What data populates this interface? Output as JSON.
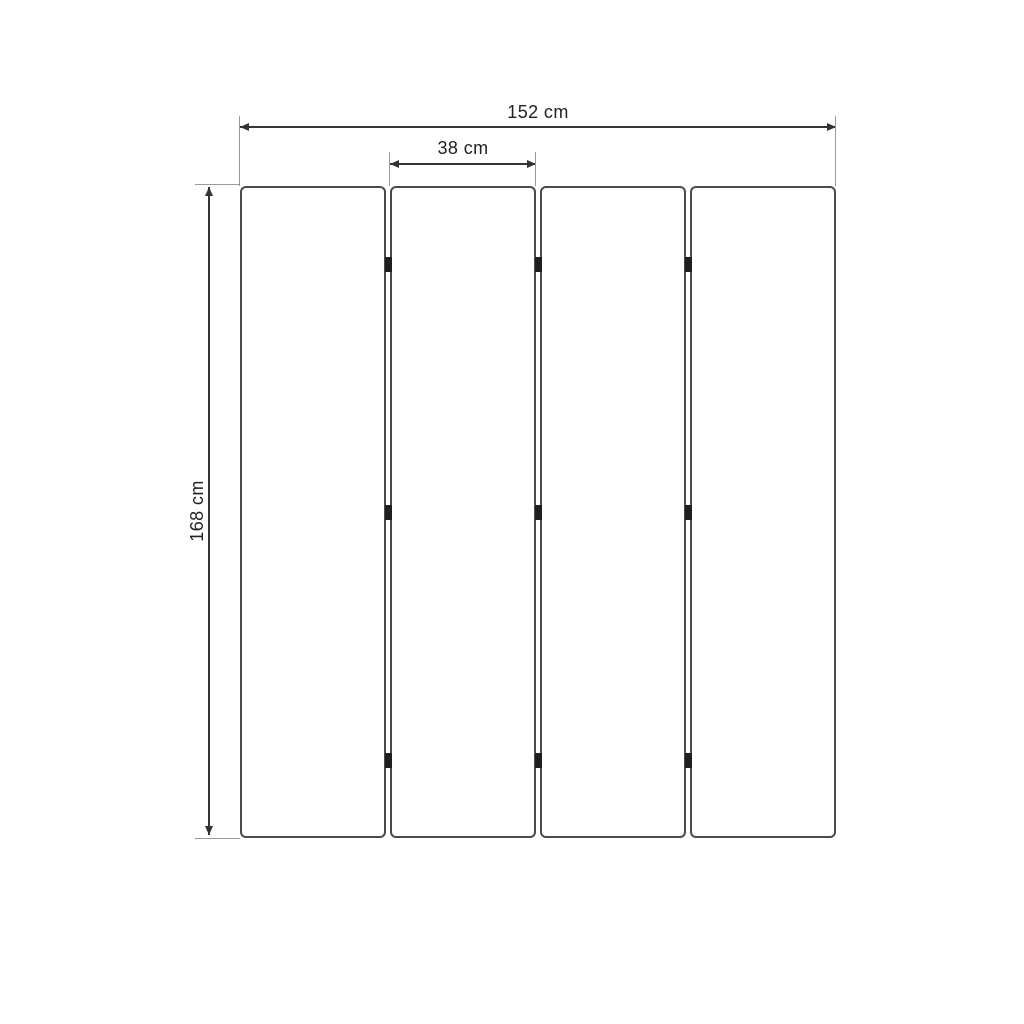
{
  "diagram": {
    "labels": {
      "total_width": "152 cm",
      "panel_width": "38 cm",
      "height": "168 cm"
    },
    "panels": {
      "count": 4,
      "hinge_rows": 3
    },
    "colors": {
      "background": "#ffffff",
      "panel_fill": "#ffffff",
      "panel_border": "#4a4a4a",
      "dimension_line": "#333333",
      "extension_line": "#999999",
      "hinge": "#1f1f1f",
      "text": "#222222"
    }
  }
}
